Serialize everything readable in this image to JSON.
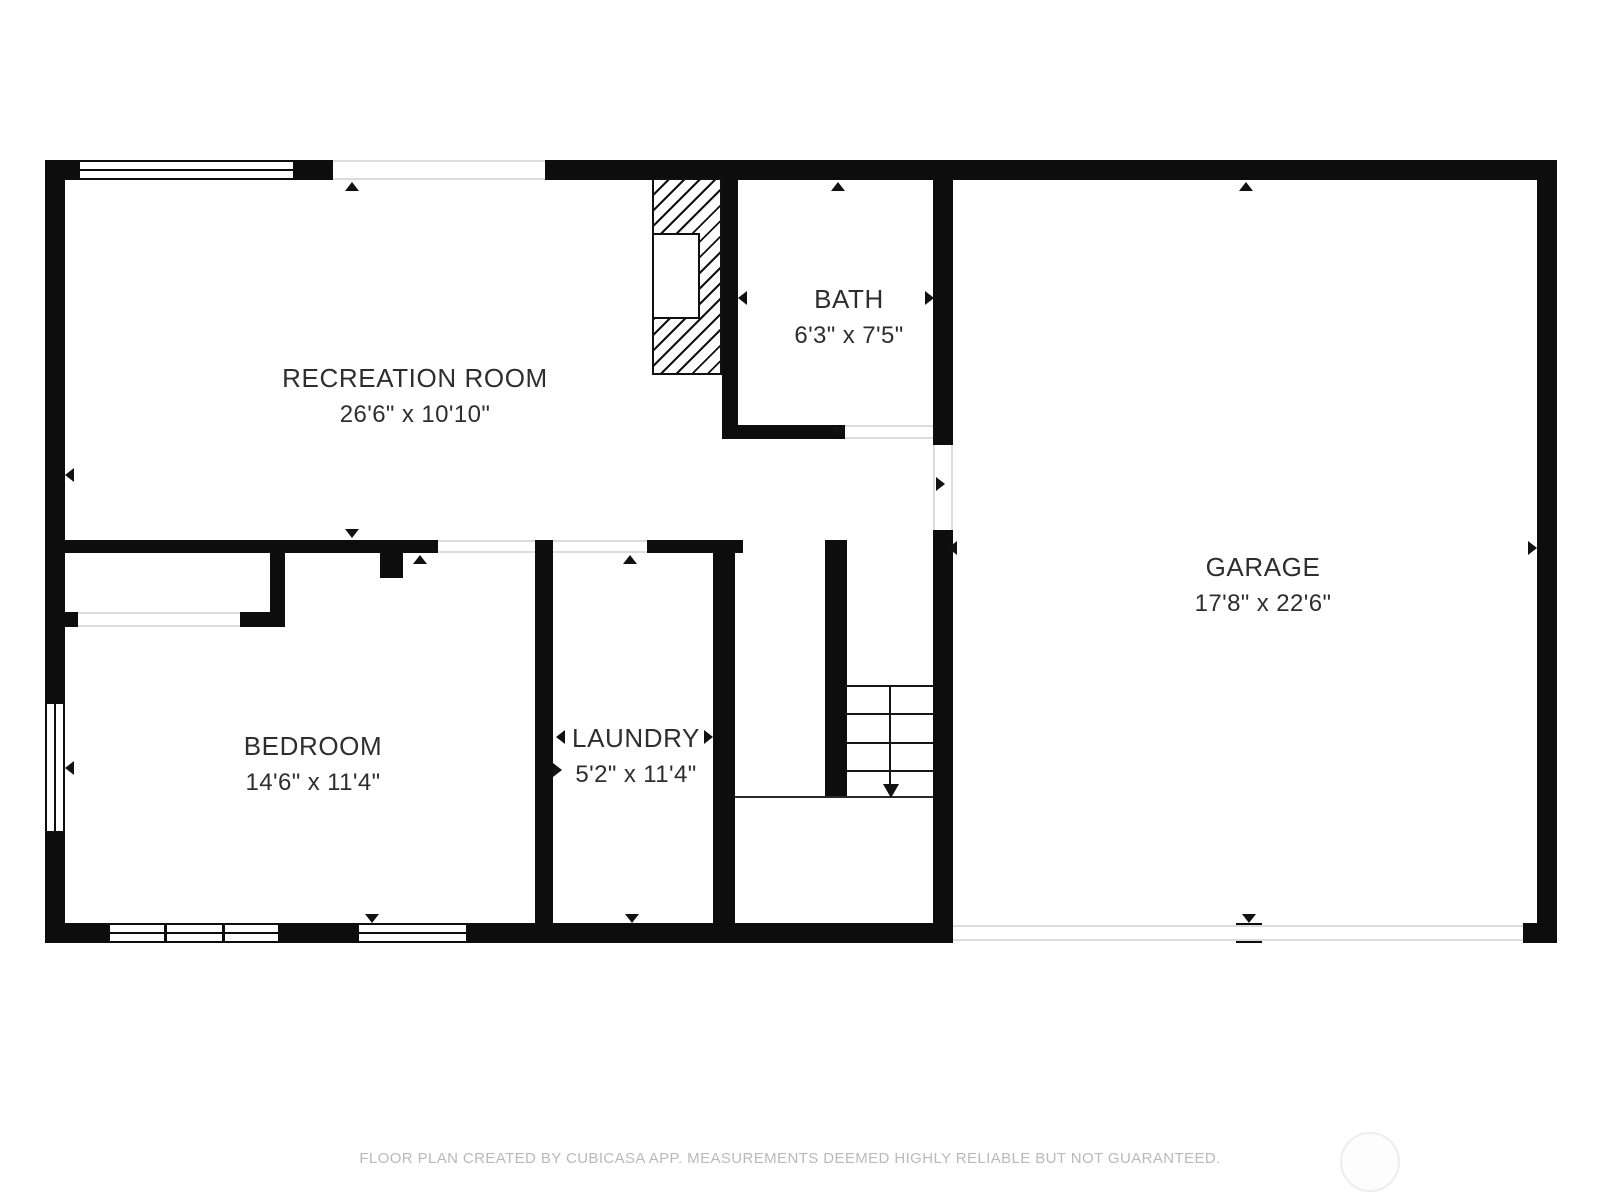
{
  "floor_plan": {
    "rooms": [
      {
        "name": "RECREATION ROOM",
        "dimensions": "26'6\" x 10'10\""
      },
      {
        "name": "BATH",
        "dimensions": "6'3\" x 7'5\""
      },
      {
        "name": "GARAGE",
        "dimensions": "17'8\" x 22'6\""
      },
      {
        "name": "BEDROOM",
        "dimensions": "14'6\" x 11'4\""
      },
      {
        "name": "LAUNDRY",
        "dimensions": "5'2\" x 11'4\""
      }
    ],
    "features": {
      "stairs_icon": "stairs-down-arrow",
      "fireplace_icon": "hatched-chimney",
      "door_markers": "small-triangle-arrows",
      "garage_door": "double-thin-line-opening"
    },
    "colors": {
      "wall": "#0d0d0d",
      "label_text": "#2e2e2e",
      "opening_line": "#dcdcdc",
      "footer_text": "#b9b9b9",
      "logo_ring": "#ededed"
    }
  },
  "footer": {
    "disclaimer": "FLOOR PLAN CREATED BY CUBICASA APP. MEASUREMENTS DEEMED HIGHLY RELIABLE BUT NOT GUARANTEED."
  }
}
